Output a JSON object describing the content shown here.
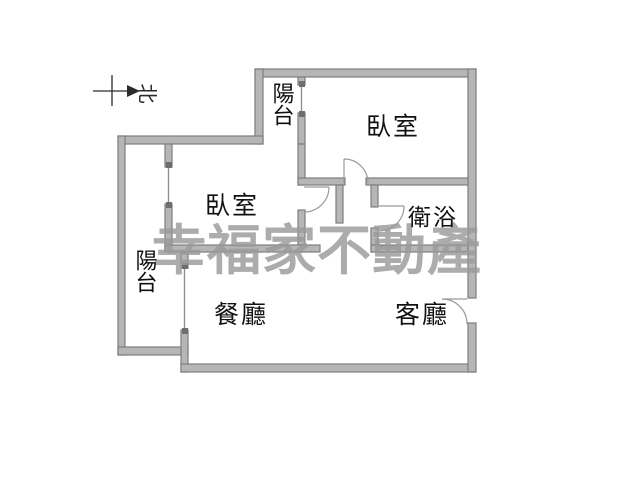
{
  "compass": {
    "north_label": "北"
  },
  "watermark": {
    "text": "幸福家不動產"
  },
  "rooms": {
    "balcony_top": {
      "label": "陽台"
    },
    "bedroom_main": {
      "label": "臥室"
    },
    "bedroom_second": {
      "label": "臥室"
    },
    "balcony_left": {
      "label": "陽台"
    },
    "bathroom": {
      "label": "衛浴"
    },
    "dining": {
      "label": "餐廳"
    },
    "living": {
      "label": "客廳"
    }
  },
  "colors": {
    "wall_fill": "#b6b6b6",
    "wall_edge": "#7d7d7d",
    "window_line": "#909090",
    "door_line": "#9a9a9a",
    "watermark": "#9a9a9a",
    "label": "#111111",
    "background": "#ffffff"
  }
}
